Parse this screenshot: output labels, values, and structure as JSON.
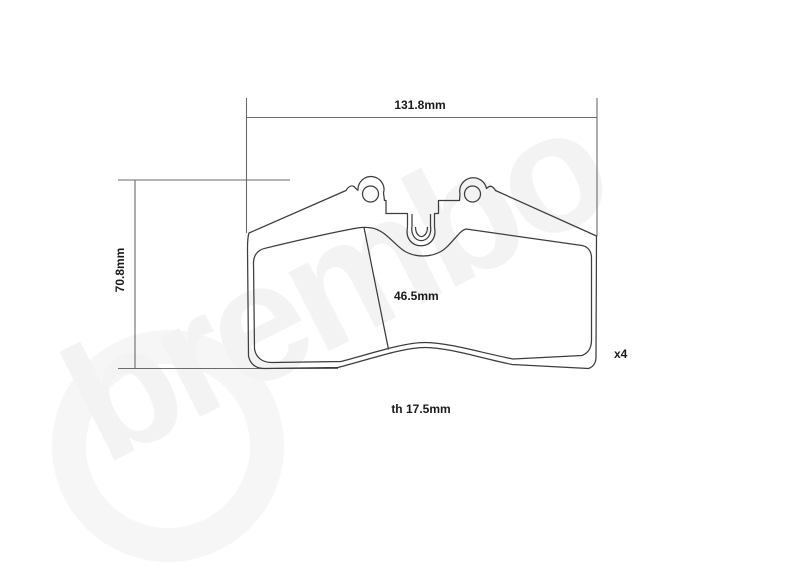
{
  "watermark": {
    "text": "brembo",
    "color": "#f3f3f3"
  },
  "drawing": {
    "type": "technical-drawing",
    "subject": "brake-pad-front-view",
    "quantity": "x4",
    "dimensions": {
      "width": "131.8mm",
      "height": "70.8mm",
      "friction_height": "46.5mm",
      "thickness": "th 17.5mm"
    },
    "colors": {
      "outline": "#3d3d3d",
      "dimension_lines": "#6b6b6b",
      "labels": "#1a1a1a",
      "background": "#ffffff"
    }
  }
}
